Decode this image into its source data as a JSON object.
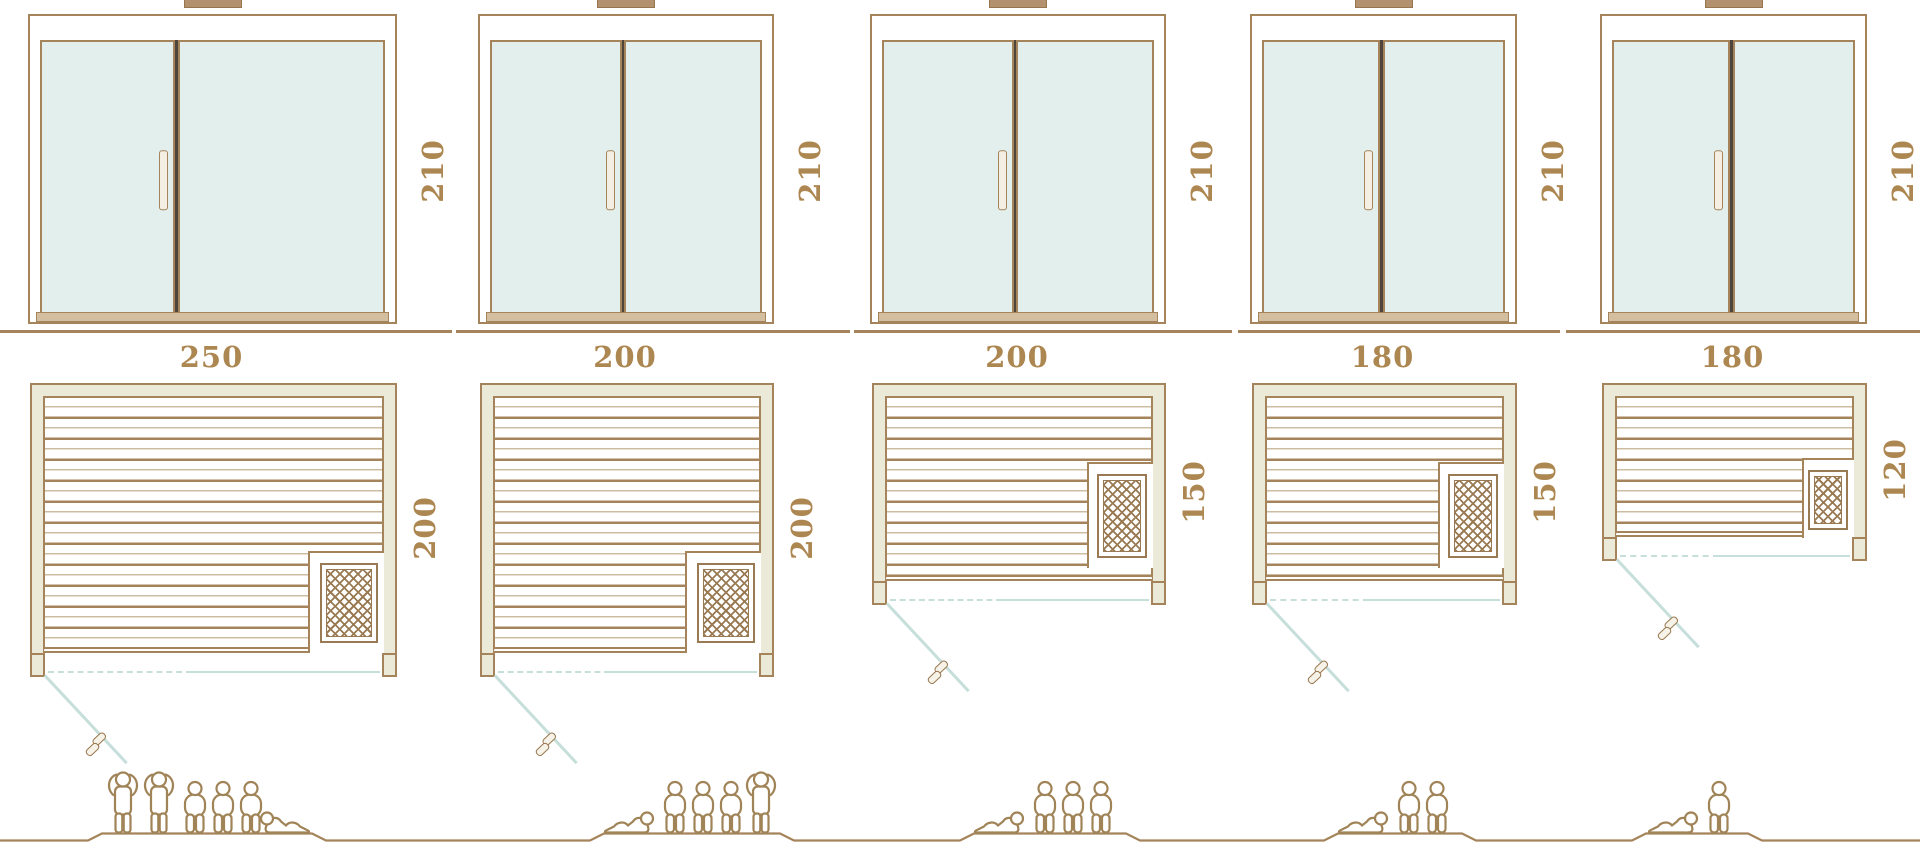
{
  "units": [
    {
      "door_height_label": "210",
      "width_label": "250",
      "depth_label": "200",
      "capacity": 6,
      "people_poses": [
        "standing",
        "standing",
        "sitting",
        "sitting",
        "sitting",
        "lying"
      ]
    },
    {
      "door_height_label": "210",
      "width_label": "200",
      "depth_label": "200",
      "capacity": 5,
      "people_poses": [
        "lying",
        "sitting",
        "sitting",
        "sitting",
        "standing"
      ]
    },
    {
      "door_height_label": "210",
      "width_label": "200",
      "depth_label": "150",
      "capacity": 4,
      "people_poses": [
        "lying",
        "sitting",
        "sitting",
        "sitting"
      ]
    },
    {
      "door_height_label": "210",
      "width_label": "180",
      "depth_label": "150",
      "capacity": 3,
      "people_poses": [
        "lying",
        "sitting",
        "sitting"
      ]
    },
    {
      "door_height_label": "210",
      "width_label": "180",
      "depth_label": "120",
      "capacity": 2,
      "people_poses": [
        "lying",
        "sitting"
      ]
    }
  ],
  "colors": {
    "line_brown": "#a5845c",
    "brown_dark": "#97764e",
    "text_brown": "#ad8751",
    "frame_beige": "#ebead9",
    "glass_teal": "#e2efec",
    "swing_teal": "#c7dfdb",
    "slat_light": "#cdbda0",
    "divider_dark": "#4e463c",
    "heater_brown": "#9a7a52",
    "threshold_tan": "#d3bf9f",
    "chimney_fill": "#b3916e"
  }
}
